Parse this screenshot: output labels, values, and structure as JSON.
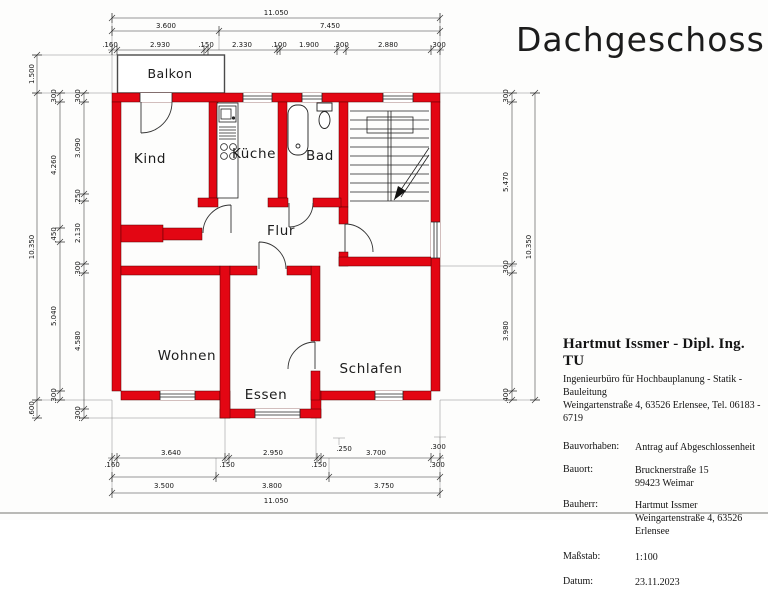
{
  "title": "Dachgeschoss",
  "colors": {
    "wall_red": "#e30613",
    "line": "#222222"
  },
  "rooms": {
    "balkon": "Balkon",
    "kind": "Kind",
    "kueche": "Küche",
    "bad": "Bad",
    "flur": "Flur",
    "wohnen": "Wohnen",
    "essen": "Essen",
    "schlafen": "Schlafen"
  },
  "dimensions": {
    "top": {
      "total": "11.050",
      "row2": [
        "3.600",
        "7.450"
      ],
      "row3": [
        ".160",
        "2.930",
        ".150",
        "2.330",
        ".100",
        "1.900",
        ".300",
        "2.880",
        ".300"
      ]
    },
    "bottom": {
      "row1_above": [
        "3.640",
        "2.950",
        "3.700"
      ],
      "row1_below": [
        ".160",
        ".150",
        ".150",
        ".300"
      ],
      "floating": [
        ".250",
        ".300"
      ],
      "row2": [
        "3.500",
        "3.800",
        "3.750"
      ],
      "total": "11.050"
    },
    "left": {
      "outer": [
        "1.500",
        "10.350",
        ".600"
      ],
      "middle": [
        ".300",
        "4.260",
        ".450",
        "5.040",
        ".300"
      ],
      "inner": [
        ".300",
        "3.090",
        ".250",
        "2.130",
        ".300",
        "4.580",
        ".300"
      ]
    },
    "right": {
      "inner": [
        ".300",
        "5.470",
        ".300",
        "3.980",
        ".400"
      ],
      "outer": "10.350"
    }
  },
  "title_block": {
    "name": "Hartmut Issmer - Dipl. Ing. TU",
    "line1": "Ingenieurbüro für Hochbauplanung - Statik - Bauleitung",
    "line2": "Weingartenstraße 4, 63526 Erlensee, Tel. 06183 - 6719",
    "rows": [
      {
        "label": "Bauvorhaben:",
        "value": "Antrag auf Abgeschlossenheit"
      },
      {
        "label": "Bauort:",
        "value": "Brucknerstraße 15",
        "value2": "99423 Weimar"
      },
      {
        "label": "Bauherr:",
        "value": "Hartmut Issmer",
        "value2": "Weingartenstraße 4, 63526 Erlensee"
      },
      {
        "label": "Maßstab:",
        "value": "1:100"
      },
      {
        "label": "Datum:",
        "value": "23.11.2023"
      }
    ]
  }
}
